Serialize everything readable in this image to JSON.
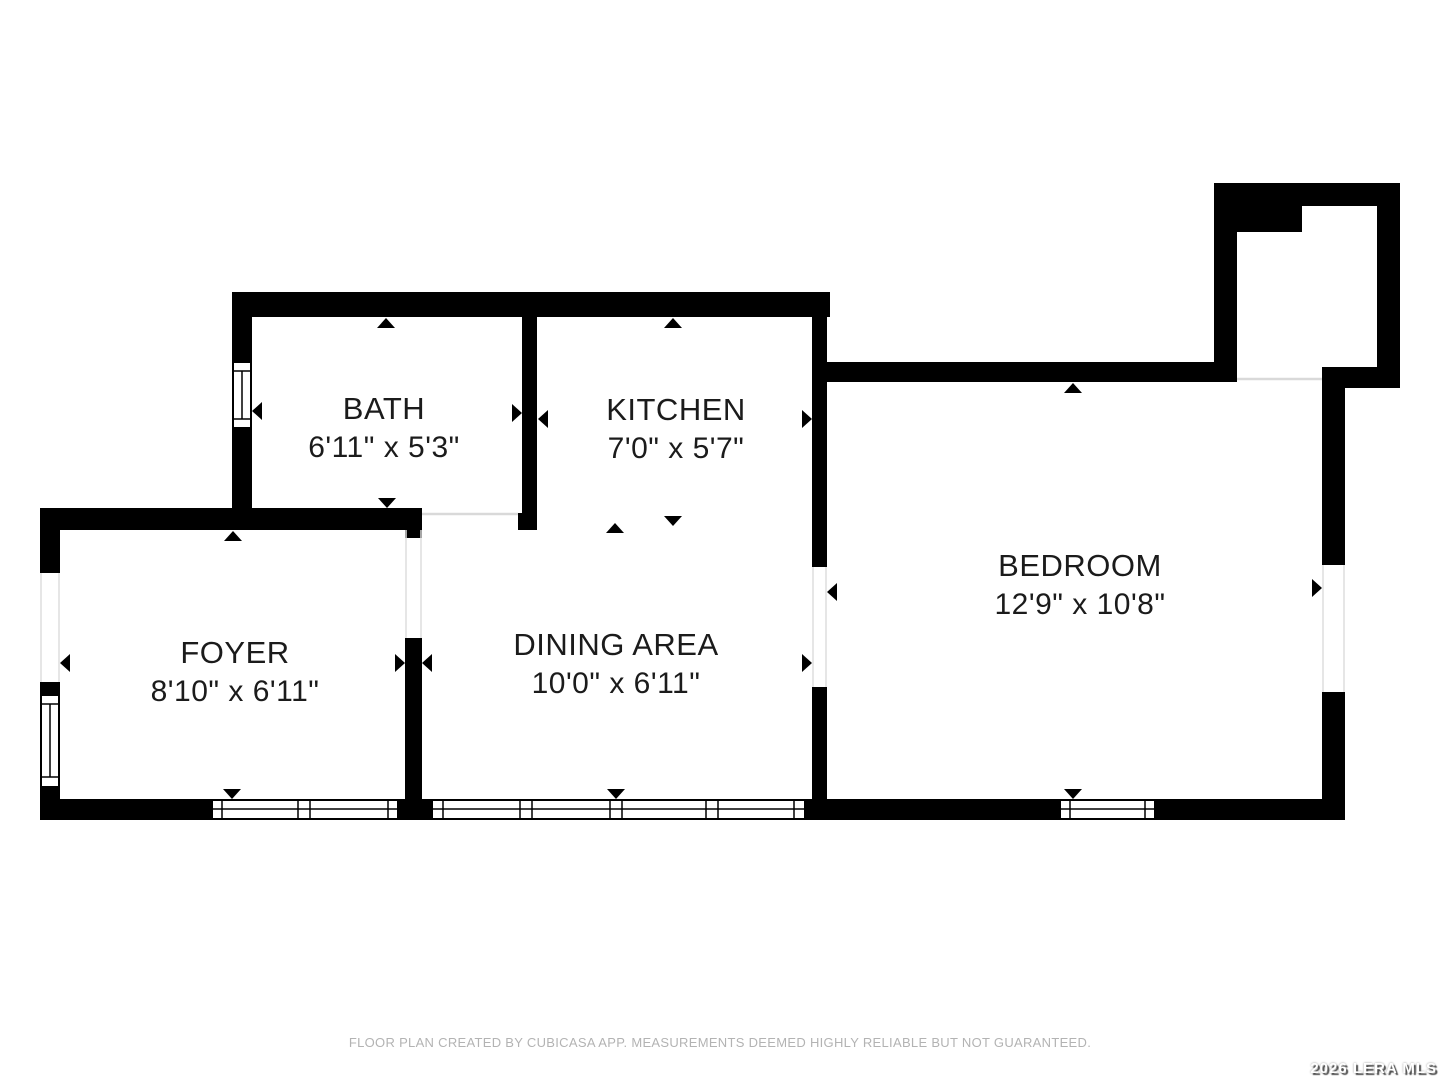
{
  "plan": {
    "rooms": [
      {
        "name": "BATH",
        "dims": "6'11\" x 5'3\""
      },
      {
        "name": "KITCHEN",
        "dims": "7'0\" x 5'7\""
      },
      {
        "name": "FOYER",
        "dims": "8'10\" x 6'11\""
      },
      {
        "name": "DINING AREA",
        "dims": "10'0\" x 6'11\""
      },
      {
        "name": "BEDROOM",
        "dims": "12'9\" x 10'8\""
      }
    ]
  },
  "footer": {
    "disclaimer": "FLOOR PLAN CREATED BY CUBICASA APP. MEASUREMENTS DEEMED HIGHLY RELIABLE BUT NOT GUARANTEED."
  },
  "watermark": {
    "text": "2026 LERA MLS"
  },
  "colors": {
    "wall": "#000000",
    "label": "#1b1b1b",
    "threshold": "#d9d9d9",
    "disclaimer": "#b3b3b3",
    "watermark": "#ffffff"
  }
}
